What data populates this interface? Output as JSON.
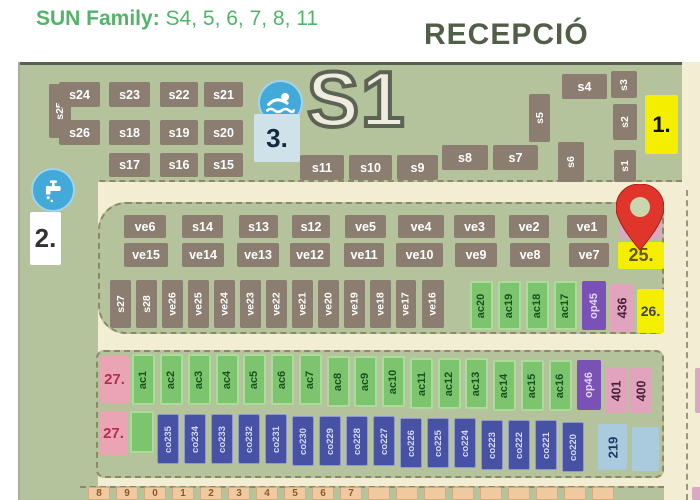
{
  "header": {
    "title_bold": "SUN Family:",
    "title_rest": " S4, 5, 6, 7, 8, 11",
    "reception": "RECEPCIÓ"
  },
  "map": {
    "zone_label": "S1",
    "plots": [
      {
        "l": "s25",
        "x": 29,
        "y": 22,
        "w": 22,
        "h": 54,
        "t": "bv"
      },
      {
        "l": "s24",
        "x": 39,
        "y": 20,
        "w": 41,
        "h": 25,
        "t": "bh"
      },
      {
        "l": "s23",
        "x": 89,
        "y": 20,
        "w": 41,
        "h": 25,
        "t": "bh"
      },
      {
        "l": "s22",
        "x": 140,
        "y": 20,
        "w": 38,
        "h": 25,
        "t": "bh"
      },
      {
        "l": "s21",
        "x": 184,
        "y": 20,
        "w": 39,
        "h": 25,
        "t": "bh"
      },
      {
        "l": "s26",
        "x": 39,
        "y": 58,
        "w": 41,
        "h": 25,
        "t": "bh"
      },
      {
        "l": "s18",
        "x": 89,
        "y": 58,
        "w": 41,
        "h": 25,
        "t": "bh"
      },
      {
        "l": "s19",
        "x": 140,
        "y": 58,
        "w": 38,
        "h": 25,
        "t": "bh"
      },
      {
        "l": "s20",
        "x": 184,
        "y": 58,
        "w": 39,
        "h": 25,
        "t": "bh"
      },
      {
        "l": "s17",
        "x": 89,
        "y": 91,
        "w": 41,
        "h": 24,
        "t": "bh"
      },
      {
        "l": "s16",
        "x": 140,
        "y": 91,
        "w": 38,
        "h": 24,
        "t": "bh"
      },
      {
        "l": "s15",
        "x": 184,
        "y": 91,
        "w": 39,
        "h": 24,
        "t": "bh"
      },
      {
        "l": "s11",
        "x": 280,
        "y": 93,
        "w": 44,
        "h": 25,
        "t": "bh"
      },
      {
        "l": "s10",
        "x": 329,
        "y": 93,
        "w": 43,
        "h": 25,
        "t": "bh"
      },
      {
        "l": "s9",
        "x": 377,
        "y": 93,
        "w": 41,
        "h": 25,
        "t": "bh"
      },
      {
        "l": "s8",
        "x": 422,
        "y": 83,
        "w": 46,
        "h": 25,
        "t": "bh"
      },
      {
        "l": "s7",
        "x": 473,
        "y": 83,
        "w": 45,
        "h": 25,
        "t": "bh"
      },
      {
        "l": "s5",
        "x": 509,
        "y": 32,
        "w": 21,
        "h": 48,
        "t": "bv"
      },
      {
        "l": "s6",
        "x": 538,
        "y": 80,
        "w": 26,
        "h": 40,
        "t": "bv"
      },
      {
        "l": "s4",
        "x": 542,
        "y": 12,
        "w": 45,
        "h": 25,
        "t": "bh"
      },
      {
        "l": "s3",
        "x": 591,
        "y": 9,
        "w": 26,
        "h": 27,
        "t": "bv"
      },
      {
        "l": "s2",
        "x": 593,
        "y": 42,
        "w": 24,
        "h": 36,
        "t": "bv"
      },
      {
        "l": "s1",
        "x": 594,
        "y": 88,
        "w": 22,
        "h": 32,
        "t": "bv"
      },
      {
        "l": "ve6",
        "x": 104,
        "y": 153,
        "w": 42,
        "h": 23,
        "t": "bh"
      },
      {
        "l": "s14",
        "x": 162,
        "y": 153,
        "w": 41,
        "h": 23,
        "t": "bh"
      },
      {
        "l": "s13",
        "x": 219,
        "y": 153,
        "w": 39,
        "h": 23,
        "t": "bh"
      },
      {
        "l": "s12",
        "x": 272,
        "y": 153,
        "w": 38,
        "h": 23,
        "t": "bh"
      },
      {
        "l": "ve5",
        "x": 325,
        "y": 153,
        "w": 41,
        "h": 23,
        "t": "bh"
      },
      {
        "l": "ve4",
        "x": 378,
        "y": 153,
        "w": 46,
        "h": 23,
        "t": "bh"
      },
      {
        "l": "ve3",
        "x": 434,
        "y": 153,
        "w": 41,
        "h": 23,
        "t": "bh"
      },
      {
        "l": "ve2",
        "x": 489,
        "y": 153,
        "w": 40,
        "h": 23,
        "t": "bh"
      },
      {
        "l": "ve1",
        "x": 547,
        "y": 153,
        "w": 40,
        "h": 23,
        "t": "bh"
      },
      {
        "l": "",
        "x": 599,
        "y": 150,
        "w": 43,
        "h": 27,
        "t": "ke"
      },
      {
        "l": "ve15",
        "x": 104,
        "y": 181,
        "w": 44,
        "h": 24,
        "t": "bh"
      },
      {
        "l": "ve14",
        "x": 162,
        "y": 181,
        "w": 42,
        "h": 24,
        "t": "bh"
      },
      {
        "l": "ve13",
        "x": 217,
        "y": 181,
        "w": 42,
        "h": 24,
        "t": "bh"
      },
      {
        "l": "ve12",
        "x": 270,
        "y": 181,
        "w": 40,
        "h": 24,
        "t": "bh"
      },
      {
        "l": "ve11",
        "x": 324,
        "y": 181,
        "w": 40,
        "h": 24,
        "t": "bh"
      },
      {
        "l": "ve10",
        "x": 376,
        "y": 181,
        "w": 47,
        "h": 24,
        "t": "bh"
      },
      {
        "l": "ve9",
        "x": 435,
        "y": 181,
        "w": 42,
        "h": 24,
        "t": "bh"
      },
      {
        "l": "ve8",
        "x": 490,
        "y": 181,
        "w": 40,
        "h": 24,
        "t": "bh"
      },
      {
        "l": "ve7",
        "x": 549,
        "y": 181,
        "w": 40,
        "h": 24,
        "t": "bh"
      },
      {
        "l": "s27",
        "x": 90,
        "y": 218,
        "w": 21,
        "h": 48,
        "t": "bv"
      },
      {
        "l": "s28",
        "x": 116,
        "y": 218,
        "w": 21,
        "h": 48,
        "t": "bv"
      },
      {
        "l": "ve26",
        "x": 142,
        "y": 218,
        "w": 21,
        "h": 48,
        "t": "bv"
      },
      {
        "l": "ve25",
        "x": 168,
        "y": 218,
        "w": 21,
        "h": 48,
        "t": "bv"
      },
      {
        "l": "ve24",
        "x": 194,
        "y": 218,
        "w": 21,
        "h": 48,
        "t": "bv"
      },
      {
        "l": "ve23",
        "x": 220,
        "y": 218,
        "w": 21,
        "h": 48,
        "t": "bv"
      },
      {
        "l": "ve22",
        "x": 246,
        "y": 218,
        "w": 21,
        "h": 48,
        "t": "bv"
      },
      {
        "l": "ve21",
        "x": 272,
        "y": 218,
        "w": 21,
        "h": 48,
        "t": "bv"
      },
      {
        "l": "ve20",
        "x": 298,
        "y": 218,
        "w": 21,
        "h": 48,
        "t": "bv"
      },
      {
        "l": "ve19",
        "x": 324,
        "y": 218,
        "w": 21,
        "h": 48,
        "t": "bv"
      },
      {
        "l": "ve18",
        "x": 350,
        "y": 218,
        "w": 21,
        "h": 48,
        "t": "bv"
      },
      {
        "l": "ve17",
        "x": 376,
        "y": 218,
        "w": 20,
        "h": 48,
        "t": "bv"
      },
      {
        "l": "ve16",
        "x": 402,
        "y": 218,
        "w": 22,
        "h": 48,
        "t": "bv"
      },
      {
        "l": "ac20",
        "x": 450,
        "y": 219,
        "w": 23,
        "h": 49,
        "t": "gv"
      },
      {
        "l": "ac19",
        "x": 478,
        "y": 219,
        "w": 23,
        "h": 49,
        "t": "gv"
      },
      {
        "l": "ac18",
        "x": 506,
        "y": 219,
        "w": 23,
        "h": 49,
        "t": "gv"
      },
      {
        "l": "ac17",
        "x": 534,
        "y": 219,
        "w": 23,
        "h": 49,
        "t": "gv"
      },
      {
        "l": "op45",
        "x": 562,
        "y": 219,
        "w": 24,
        "h": 49,
        "t": "pv"
      },
      {
        "l": "436",
        "x": 590,
        "y": 222,
        "w": 24,
        "h": 48,
        "t": "kv"
      },
      {
        "l": "ac1",
        "x": 112,
        "y": 292,
        "w": 23,
        "h": 51,
        "t": "gv"
      },
      {
        "l": "ac2",
        "x": 140,
        "y": 292,
        "w": 23,
        "h": 51,
        "t": "gv"
      },
      {
        "l": "ac3",
        "x": 168,
        "y": 292,
        "w": 23,
        "h": 51,
        "t": "gv"
      },
      {
        "l": "ac4",
        "x": 196,
        "y": 292,
        "w": 23,
        "h": 51,
        "t": "gv"
      },
      {
        "l": "ac5",
        "x": 223,
        "y": 292,
        "w": 23,
        "h": 51,
        "t": "gv"
      },
      {
        "l": "ac6",
        "x": 251,
        "y": 292,
        "w": 23,
        "h": 51,
        "t": "gv"
      },
      {
        "l": "ac7",
        "x": 279,
        "y": 292,
        "w": 23,
        "h": 51,
        "t": "gv"
      },
      {
        "l": "ac8",
        "x": 307,
        "y": 294,
        "w": 23,
        "h": 51,
        "t": "gv"
      },
      {
        "l": "ac9",
        "x": 334,
        "y": 294,
        "w": 23,
        "h": 51,
        "t": "gv"
      },
      {
        "l": "ac10",
        "x": 362,
        "y": 294,
        "w": 23,
        "h": 51,
        "t": "gv"
      },
      {
        "l": "ac11",
        "x": 390,
        "y": 296,
        "w": 23,
        "h": 51,
        "t": "gv"
      },
      {
        "l": "ac12",
        "x": 418,
        "y": 296,
        "w": 23,
        "h": 51,
        "t": "gv"
      },
      {
        "l": "ac13",
        "x": 445,
        "y": 296,
        "w": 23,
        "h": 51,
        "t": "gv"
      },
      {
        "l": "ac14",
        "x": 473,
        "y": 298,
        "w": 23,
        "h": 51,
        "t": "gv"
      },
      {
        "l": "ac15",
        "x": 501,
        "y": 298,
        "w": 23,
        "h": 51,
        "t": "gv"
      },
      {
        "l": "ac16",
        "x": 529,
        "y": 298,
        "w": 23,
        "h": 51,
        "t": "gv"
      },
      {
        "l": "op46",
        "x": 557,
        "y": 298,
        "w": 24,
        "h": 50,
        "t": "pv"
      },
      {
        "l": "401",
        "x": 585,
        "y": 306,
        "w": 22,
        "h": 45,
        "t": "kv"
      },
      {
        "l": "400",
        "x": 610,
        "y": 306,
        "w": 22,
        "h": 45,
        "t": "kv"
      },
      {
        "l": "",
        "x": 110,
        "y": 349,
        "w": 24,
        "h": 42,
        "t": "ge"
      },
      {
        "l": "co235",
        "x": 137,
        "y": 352,
        "w": 22,
        "h": 50,
        "t": "cv"
      },
      {
        "l": "co234",
        "x": 164,
        "y": 352,
        "w": 22,
        "h": 50,
        "t": "cv"
      },
      {
        "l": "co233",
        "x": 191,
        "y": 352,
        "w": 22,
        "h": 50,
        "t": "cv"
      },
      {
        "l": "co232",
        "x": 218,
        "y": 352,
        "w": 22,
        "h": 50,
        "t": "cv"
      },
      {
        "l": "co231",
        "x": 245,
        "y": 352,
        "w": 22,
        "h": 50,
        "t": "cv"
      },
      {
        "l": "co230",
        "x": 272,
        "y": 354,
        "w": 22,
        "h": 50,
        "t": "cv"
      },
      {
        "l": "co229",
        "x": 299,
        "y": 354,
        "w": 22,
        "h": 50,
        "t": "cv"
      },
      {
        "l": "co228",
        "x": 326,
        "y": 354,
        "w": 22,
        "h": 50,
        "t": "cv"
      },
      {
        "l": "co227",
        "x": 353,
        "y": 354,
        "w": 22,
        "h": 50,
        "t": "cv"
      },
      {
        "l": "co226",
        "x": 380,
        "y": 356,
        "w": 22,
        "h": 50,
        "t": "cv"
      },
      {
        "l": "co225",
        "x": 407,
        "y": 356,
        "w": 22,
        "h": 50,
        "t": "cv"
      },
      {
        "l": "co224",
        "x": 434,
        "y": 356,
        "w": 22,
        "h": 50,
        "t": "cv"
      },
      {
        "l": "co223",
        "x": 461,
        "y": 358,
        "w": 22,
        "h": 50,
        "t": "cv"
      },
      {
        "l": "co222",
        "x": 488,
        "y": 358,
        "w": 22,
        "h": 50,
        "t": "cv"
      },
      {
        "l": "co221",
        "x": 515,
        "y": 358,
        "w": 22,
        "h": 50,
        "t": "cv"
      },
      {
        "l": "co220",
        "x": 542,
        "y": 360,
        "w": 22,
        "h": 50,
        "t": "cv"
      },
      {
        "l": "219",
        "x": 578,
        "y": 362,
        "w": 29,
        "h": 46,
        "t": "lv"
      },
      {
        "l": "",
        "x": 612,
        "y": 365,
        "w": 27,
        "h": 44,
        "t": "le"
      },
      {
        "l": "8",
        "x": 68,
        "y": 425,
        "w": 22,
        "h": 13,
        "t": "tn"
      },
      {
        "l": "9",
        "x": 96,
        "y": 425,
        "w": 22,
        "h": 13,
        "t": "tn"
      },
      {
        "l": "0",
        "x": 124,
        "y": 425,
        "w": 22,
        "h": 13,
        "t": "tn"
      },
      {
        "l": "1",
        "x": 152,
        "y": 425,
        "w": 22,
        "h": 13,
        "t": "tn"
      },
      {
        "l": "2",
        "x": 180,
        "y": 425,
        "w": 22,
        "h": 13,
        "t": "tn"
      },
      {
        "l": "3",
        "x": 208,
        "y": 425,
        "w": 22,
        "h": 13,
        "t": "tn"
      },
      {
        "l": "4",
        "x": 236,
        "y": 425,
        "w": 22,
        "h": 13,
        "t": "tn"
      },
      {
        "l": "5",
        "x": 264,
        "y": 425,
        "w": 22,
        "h": 13,
        "t": "tn"
      },
      {
        "l": "6",
        "x": 292,
        "y": 425,
        "w": 22,
        "h": 13,
        "t": "tn"
      },
      {
        "l": "7",
        "x": 320,
        "y": 425,
        "w": 22,
        "h": 13,
        "t": "tn"
      },
      {
        "l": "",
        "x": 348,
        "y": 425,
        "w": 22,
        "h": 13,
        "t": "tn"
      },
      {
        "l": "",
        "x": 376,
        "y": 425,
        "w": 22,
        "h": 13,
        "t": "tn"
      },
      {
        "l": "",
        "x": 404,
        "y": 425,
        "w": 22,
        "h": 13,
        "t": "tn"
      },
      {
        "l": "",
        "x": 432,
        "y": 425,
        "w": 22,
        "h": 13,
        "t": "tn"
      },
      {
        "l": "",
        "x": 460,
        "y": 425,
        "w": 22,
        "h": 13,
        "t": "tn"
      },
      {
        "l": "",
        "x": 488,
        "y": 425,
        "w": 22,
        "h": 13,
        "t": "tn"
      },
      {
        "l": "",
        "x": 516,
        "y": 425,
        "w": 22,
        "h": 13,
        "t": "tn"
      },
      {
        "l": "",
        "x": 544,
        "y": 425,
        "w": 22,
        "h": 13,
        "t": "tn"
      },
      {
        "l": "",
        "x": 572,
        "y": 425,
        "w": 22,
        "h": 13,
        "t": "tn"
      },
      {
        "l": "",
        "x": 675,
        "y": 306,
        "w": 7,
        "h": 45,
        "t": "ke"
      },
      {
        "l": "",
        "x": 672,
        "y": 425,
        "w": 10,
        "h": 13,
        "t": "ke"
      }
    ],
    "markers": [
      {
        "l": "1.",
        "x": 625,
        "y": 33,
        "w": 33,
        "h": 59,
        "t": "yellow",
        "fs": 22,
        "c": "#111111"
      },
      {
        "l": "2.",
        "x": 10,
        "y": 150,
        "w": 31,
        "h": 53,
        "t": "white",
        "fs": 26,
        "c": "#333333"
      },
      {
        "l": "3.",
        "x": 234,
        "y": 52,
        "w": 46,
        "h": 48,
        "t": "lightblue",
        "fs": 26,
        "c": "#12293f"
      },
      {
        "l": "25.",
        "x": 598,
        "y": 180,
        "w": 46,
        "h": 27,
        "t": "yellow",
        "fs": 18,
        "c": "#6a5500"
      },
      {
        "l": "26.",
        "x": 617,
        "y": 227,
        "w": 27,
        "h": 44,
        "t": "yellow",
        "fs": 14,
        "c": "#3f3f4f"
      },
      {
        "l": "27.",
        "x": 80,
        "y": 294,
        "w": 29,
        "h": 47,
        "t": "pink",
        "fs": 15,
        "c": "#b03050"
      },
      {
        "l": "27.",
        "x": 80,
        "y": 349,
        "w": 27,
        "h": 44,
        "t": "pink",
        "fs": 15,
        "c": "#b03050"
      }
    ],
    "icons": {
      "pool": "pool-icon",
      "tap": "water-tap-icon",
      "pin": "location-pin-icon"
    },
    "colors": {
      "accent_green": "#53b469",
      "reception_text": "#515e48",
      "map_green": "#b5c39c",
      "road_cream": "#f3edd3",
      "plot_brown": "#8b7d70",
      "plot_green": "#7cc46e",
      "plot_purple": "#7a52b5",
      "plot_pink": "#e2a4bc",
      "plot_blue": "#4852a5",
      "plot_lightblue": "#a9cbdd",
      "plot_tan": "#efc9a0",
      "marker_yellow": "#f4ee00",
      "marker_pink": "#eaa4b4",
      "pin_red": "#e0352b",
      "icon_blue": "#42a9d8"
    }
  }
}
